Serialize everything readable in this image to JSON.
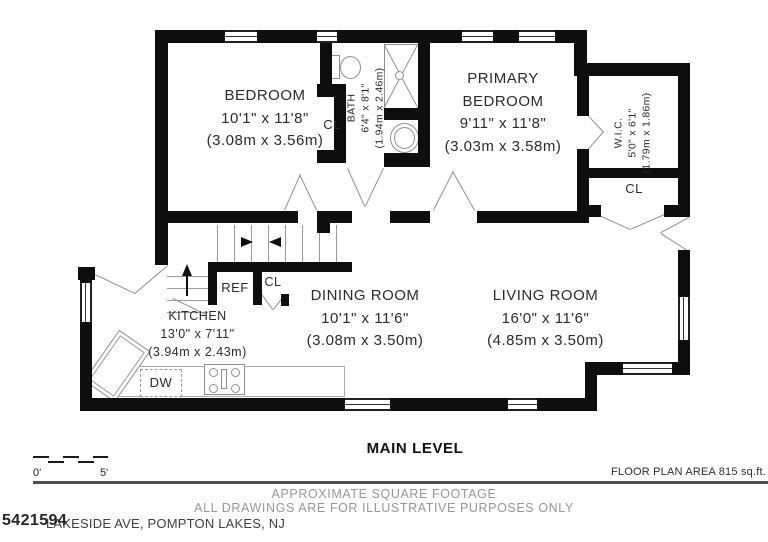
{
  "colors": {
    "wall": "#0e0e0e",
    "thin_line": "#8f8f8f",
    "text": "#2b2b2b",
    "muted_text": "#979797"
  },
  "rooms": {
    "bedroom": {
      "name": "BEDROOM",
      "dims": "10'1\" x 11'8\"",
      "metric": "(3.08m x 3.56m)"
    },
    "bath": {
      "name": "BATH",
      "dims": "6'4\" x 8'1\"",
      "metric": "(1.94m x 2.46m)"
    },
    "primary_bedroom": {
      "name_line1": "PRIMARY",
      "name_line2": "BEDROOM",
      "dims": "9'11\" x 11'8\"",
      "metric": "(3.03m x 3.58m)"
    },
    "wic": {
      "name": "W.I.C.",
      "dims": "5'0\" x 6'1\"",
      "metric": "(1.79m x 1.86m)"
    },
    "dining_room": {
      "name": "DINING ROOM",
      "dims": "10'1\" x 11'6\"",
      "metric": "(3.08m x 3.50m)"
    },
    "living_room": {
      "name": "LIVING ROOM",
      "dims": "16'0\" x 11'6\"",
      "metric": "(4.85m x 3.50m)"
    },
    "kitchen": {
      "name": "KITCHEN",
      "dims": "13'0\" x 7'11\"",
      "metric": "(3.94m x 2.43m)"
    }
  },
  "fixtures": {
    "closet": "CL",
    "refrigerator": "REF",
    "dishwasher": "DW"
  },
  "footer": {
    "level_title": "MAIN LEVEL",
    "scale_zero": "0'",
    "scale_five": "5'",
    "area_note": "FLOOR PLAN AREA 815 sq.ft.",
    "disclaimer_line1": "APPROXIMATE SQUARE FOOTAGE",
    "disclaimer_line2": "ALL DRAWINGS ARE FOR ILLUSTRATIVE PURPOSES ONLY",
    "watermark": "5421594",
    "address": "LAKESIDE AVE, POMPTON LAKES, NJ"
  }
}
